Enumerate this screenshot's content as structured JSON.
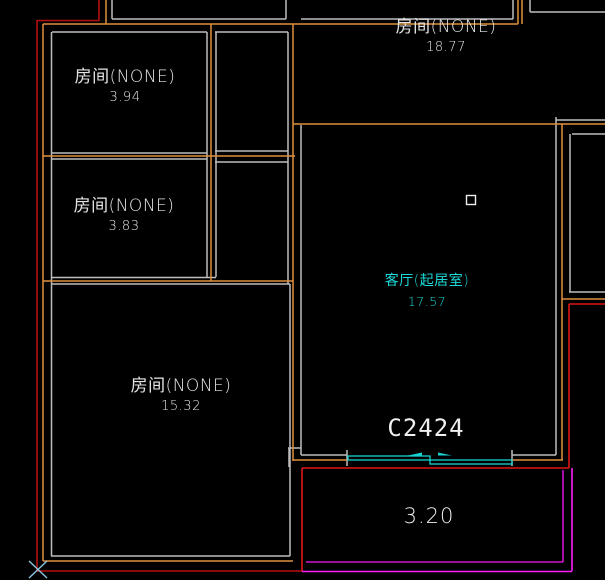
{
  "canvas": {
    "background": "#000000"
  },
  "rooms": [
    {
      "label": "房间(NONE)",
      "area": "3.94",
      "color": "#E5E5E5"
    },
    {
      "label": "房间(NONE)",
      "area": "3.83",
      "color": "#E5E5E5"
    },
    {
      "label": "房间(NONE)",
      "area": "18.77",
      "color": "#E5E5E5"
    },
    {
      "label": "房间(NONE)",
      "area": "15.32",
      "color": "#E5E5E5"
    },
    {
      "label": "客厅(起居室)",
      "area": "17.57",
      "color": "#1ADBDB"
    }
  ],
  "window": {
    "tag": "C2424"
  },
  "balcony": {
    "area": "3.20"
  },
  "colors": {
    "inner_wall": "#BDBDBD",
    "wall_axis": "#E0913D",
    "exterior_wall": "#B50E0E",
    "exterior_wall_bright": "#E01616",
    "balcony_line_inner": "#D012D0",
    "balcony_line_outer": "#FA1EFA",
    "window_symbol": "#17D1D1",
    "point_marker": "#8CC6E0",
    "grip_marker": "#EDEDED"
  }
}
